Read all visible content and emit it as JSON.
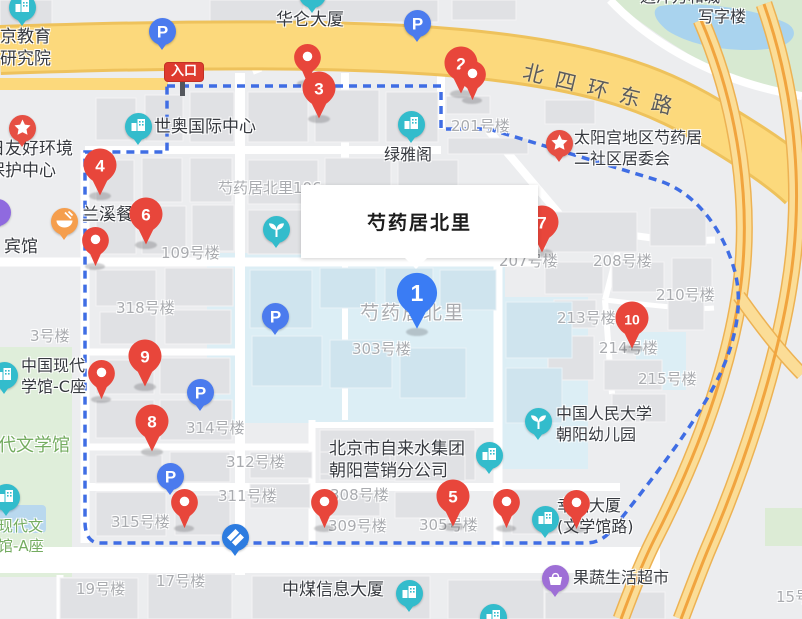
{
  "tooltip": {
    "title": "芍药居北里"
  },
  "entrance": {
    "label": "入口"
  },
  "road_name": "北四环东路",
  "palette": {
    "marker_red": "#e8463b",
    "marker_blue": "#3a7cf4",
    "boundary": "#3f6de4",
    "road_yellow": "#fcd97c",
    "ramp_yellow": "#fbdd97",
    "ramp_core": "#f1a43e",
    "icon_teal": "#33bccc",
    "icon_star": "#e64f43",
    "icon_food": "#f59e4d",
    "icon_parking": "#4b7bee",
    "icon_bank": "#2d7ce0",
    "icon_shop": "#9e6fd6",
    "icon_purple": "#8f6adf"
  },
  "numbered_markers": [
    {
      "number": "1",
      "x": 417,
      "y": 293,
      "variant": "blue"
    },
    {
      "number": "2",
      "x": 461,
      "y": 63,
      "variant": "red"
    },
    {
      "number": "3",
      "x": 319,
      "y": 88,
      "variant": "red"
    },
    {
      "number": "4",
      "x": 100,
      "y": 165,
      "variant": "red"
    },
    {
      "number": "5",
      "x": 453,
      "y": 496,
      "variant": "red"
    },
    {
      "number": "6",
      "x": 146,
      "y": 214,
      "variant": "red"
    },
    {
      "number": "7",
      "x": 542,
      "y": 222,
      "variant": "red"
    },
    {
      "number": "8",
      "x": 152,
      "y": 421,
      "variant": "red"
    },
    {
      "number": "9",
      "x": 145,
      "y": 356,
      "variant": "red"
    },
    {
      "number": "10",
      "x": 632,
      "y": 318,
      "variant": "red"
    }
  ],
  "plain_pins": [
    {
      "x": 307,
      "y": 57
    },
    {
      "x": 472,
      "y": 74,
      "z": 7
    },
    {
      "x": 95,
      "y": 240
    },
    {
      "x": 101,
      "y": 373
    },
    {
      "x": 184,
      "y": 502
    },
    {
      "x": 324,
      "y": 502
    },
    {
      "x": 506,
      "y": 502
    },
    {
      "x": 576,
      "y": 503
    }
  ],
  "poi_icons": [
    {
      "type": "building",
      "x": 22,
      "y": 7
    },
    {
      "type": "building",
      "x": 312,
      "y": -6
    },
    {
      "type": "parking",
      "x": 162,
      "y": 31
    },
    {
      "type": "parking",
      "x": 417,
      "y": 23
    },
    {
      "type": "building",
      "x": 138,
      "y": 126
    },
    {
      "type": "building",
      "x": 411,
      "y": 124
    },
    {
      "type": "star",
      "x": 22,
      "y": 128
    },
    {
      "type": "star",
      "x": 559,
      "y": 143
    },
    {
      "type": "food",
      "x": 64,
      "y": 221
    },
    {
      "type": "circle",
      "x": -3,
      "y": 212
    },
    {
      "type": "plant",
      "x": 276,
      "y": 229
    },
    {
      "type": "parking",
      "x": 275,
      "y": 316
    },
    {
      "type": "building",
      "x": 4,
      "y": 375
    },
    {
      "type": "parking",
      "x": 200,
      "y": 392
    },
    {
      "type": "plant",
      "x": 538,
      "y": 421
    },
    {
      "type": "building",
      "x": 489,
      "y": 455
    },
    {
      "type": "parking",
      "x": 170,
      "y": 476
    },
    {
      "type": "building",
      "x": 6,
      "y": 497
    },
    {
      "type": "building",
      "x": 545,
      "y": 519
    },
    {
      "type": "bank",
      "x": 235,
      "y": 537
    },
    {
      "type": "shop",
      "x": 555,
      "y": 578
    },
    {
      "type": "building",
      "x": 409,
      "y": 593
    },
    {
      "type": "building",
      "x": 493,
      "y": 617
    }
  ],
  "poi_labels": [
    {
      "lines": [
        "远洋万和城"
      ],
      "x": 640,
      "y": -13,
      "size": 16
    },
    {
      "lines": [
        "写字楼"
      ],
      "x": 698,
      "y": 7,
      "size": 16
    },
    {
      "lines": [
        "华仑大厦"
      ],
      "x": 276,
      "y": 9,
      "size": 17
    },
    {
      "lines": [
        "北京教育",
        "学研究院"
      ],
      "x": -17,
      "y": 26,
      "size": 17
    },
    {
      "lines": [
        "世奥国际中心"
      ],
      "x": 154,
      "y": 116,
      "size": 17
    },
    {
      "lines": [
        "太阳宫地区芍药居",
        "二社区居委会"
      ],
      "x": 574,
      "y": 128,
      "size": 16
    },
    {
      "lines": [
        "日友好环境",
        "保护中心"
      ],
      "x": -12,
      "y": 138,
      "size": 17
    },
    {
      "lines": [
        "绿雅阁"
      ],
      "x": 384,
      "y": 145,
      "size": 16
    },
    {
      "lines": [
        "兰溪餐厅"
      ],
      "x": 82,
      "y": 204,
      "size": 17
    },
    {
      "lines": [
        "宾馆"
      ],
      "x": 4,
      "y": 236,
      "size": 17
    },
    {
      "lines": [
        "中国现代",
        "学馆-C座"
      ],
      "x": 21,
      "y": 356,
      "size": 16
    },
    {
      "lines": [
        "中国人民大学",
        "朝阳幼儿园"
      ],
      "x": 556,
      "y": 404,
      "size": 16
    },
    {
      "lines": [
        "北京市自来水集团",
        "朝阳营销分公司"
      ],
      "x": 329,
      "y": 438,
      "size": 17
    },
    {
      "lines": [
        "幸福大厦",
        "(文学馆路)"
      ],
      "x": 557,
      "y": 496,
      "size": 16
    },
    {
      "lines": [
        "果蔬生活超市"
      ],
      "x": 573,
      "y": 568,
      "size": 16
    },
    {
      "lines": [
        "中煤信息大厦"
      ],
      "x": 282,
      "y": 579,
      "size": 17
    }
  ],
  "green_labels": [
    {
      "lines": [
        "代文学馆"
      ],
      "x": -2,
      "y": 434,
      "size": 18
    },
    {
      "lines": [
        "现代文",
        "馆-A座"
      ],
      "x": -2,
      "y": 517,
      "size": 15
    }
  ],
  "building_labels": [
    {
      "text": "芍药居北里106",
      "x": 218,
      "y": 179,
      "size": 15
    },
    {
      "text": "201号楼",
      "x": 451,
      "y": 117,
      "size": 15
    },
    {
      "text": "109号楼",
      "x": 161,
      "y": 244,
      "size": 15
    },
    {
      "text": "207号楼",
      "x": 499,
      "y": 252,
      "size": 15
    },
    {
      "text": "208号楼",
      "x": 593,
      "y": 252,
      "size": 15
    },
    {
      "text": "210号楼",
      "x": 656,
      "y": 286,
      "size": 15
    },
    {
      "text": "213号楼",
      "x": 557,
      "y": 309,
      "size": 15
    },
    {
      "text": "214号楼",
      "x": 599,
      "y": 339,
      "size": 15
    },
    {
      "text": "215号楼",
      "x": 638,
      "y": 370,
      "size": 15
    },
    {
      "text": "318号楼",
      "x": 116,
      "y": 299,
      "size": 15
    },
    {
      "text": "3号楼",
      "x": 30,
      "y": 327,
      "size": 15
    },
    {
      "text": "芍药居北里",
      "x": 360,
      "y": 301,
      "size": 19
    },
    {
      "text": "303号楼",
      "x": 352,
      "y": 340,
      "size": 15
    },
    {
      "text": "314号楼",
      "x": 186,
      "y": 419,
      "size": 15
    },
    {
      "text": "312号楼",
      "x": 226,
      "y": 453,
      "size": 15
    },
    {
      "text": "311号楼",
      "x": 218,
      "y": 487,
      "size": 15
    },
    {
      "text": "315号楼",
      "x": 111,
      "y": 513,
      "size": 15
    },
    {
      "text": "308号楼",
      "x": 330,
      "y": 486,
      "size": 15
    },
    {
      "text": "309号楼",
      "x": 328,
      "y": 517,
      "size": 15
    },
    {
      "text": "305号楼",
      "x": 419,
      "y": 516,
      "size": 15
    },
    {
      "text": "19号楼",
      "x": 76,
      "y": 580,
      "size": 15
    },
    {
      "text": "17号楼",
      "x": 156,
      "y": 572,
      "size": 15
    },
    {
      "text": "15号",
      "x": 776,
      "y": 588,
      "size": 15
    }
  ]
}
